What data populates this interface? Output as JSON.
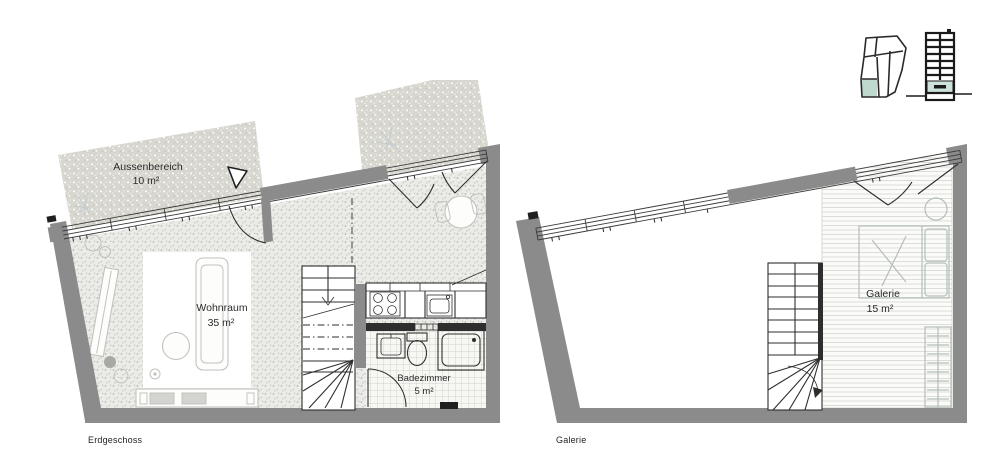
{
  "sheet_title": "floor-plan-sheet",
  "plans": {
    "erdgeschoss": {
      "caption": "Erdgeschoss",
      "outdoor_name": "Aussenbereich",
      "outdoor_area": "10 m²",
      "living_name": "Wohnraum",
      "living_area": "35 m²",
      "bath_name": "Badezimmer",
      "bath_area": "5 m²"
    },
    "galerie": {
      "caption": "Galerie",
      "gallery_name": "Galerie",
      "gallery_area": "15 m²"
    }
  },
  "keyplan": {
    "site_icon": "site-plan-unit-highlight",
    "section_icon": "building-section-floor-highlight"
  },
  "colors": {
    "wall_gray": "#8b8b8b",
    "mint_highlight": "#bfd9cc",
    "mint_light": "#cde3d9",
    "outdoor_fill": "#d8d7cf",
    "floor_base": "#ebebe7",
    "line": "#2e2e2e"
  }
}
